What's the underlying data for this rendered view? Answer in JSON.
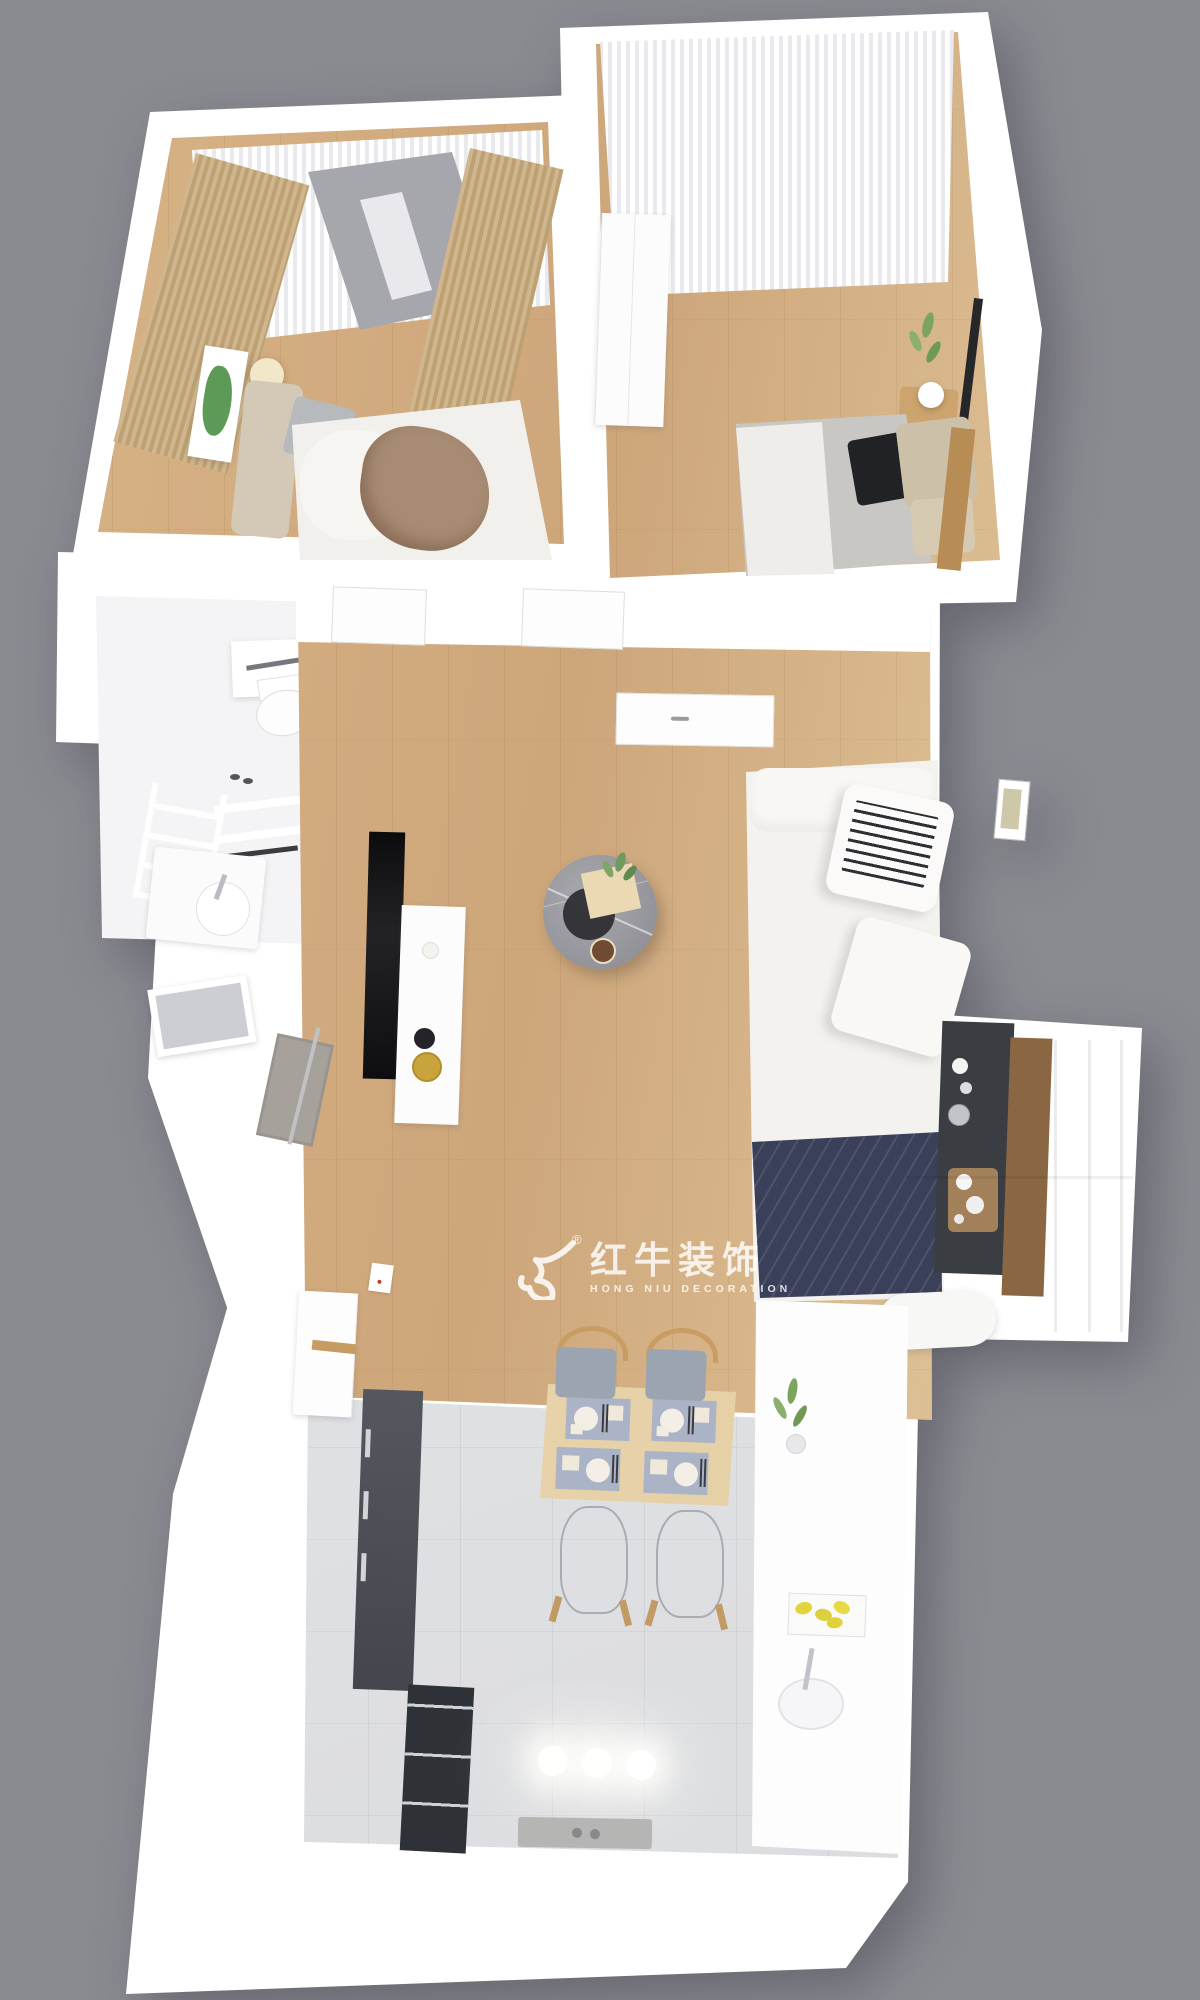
{
  "scene": {
    "kind": "3d-apartment-floorplan-render",
    "camera": "top-down-dollhouse-view",
    "background_color": "#8a8a91"
  },
  "watermark": {
    "logo": "hongniu-bull-logo",
    "registered": "®",
    "brand_cn": "红牛装饰",
    "brand_en": "HONG NIU DECORATION"
  },
  "palette": {
    "wall_white": "#ffffff",
    "wood_floor": "#d2ab7e",
    "tile_floor": "#e0e1e3",
    "curtain_tan": "#c8af88",
    "sheer_white": "#f2f2f5",
    "sofa_white": "#f5f4f1",
    "throw_navy": "#3a4059",
    "coffee_table_marble": "#97979d",
    "desk_dark": "#3a3d42",
    "desk_wood": "#8a6742",
    "chair_gray": "#9aa5b1",
    "chair_wood": "#c99d62",
    "appliance_dark": "#4b4f55",
    "lemon_yellow": "#e4d43c",
    "plant_green": "#7ca45f",
    "bed_throw_brown": "#a78b73",
    "pillow_black": "#202226",
    "pillow_beige": "#ccc0a9"
  },
  "rooms": [
    {
      "id": "bedroom-master",
      "features": [
        "tan-curtains",
        "sheer-window",
        "green-wall-art",
        "ball-lamp",
        "bed-gray-pillows-brown-throw",
        "wood-floor"
      ]
    },
    {
      "id": "bedroom-second",
      "features": [
        "sheer-curtain-wall",
        "white-wardrobe",
        "plant-wall-decal",
        "picture-frame",
        "bedside-bench-lamp",
        "bed-black-beige-pillows",
        "wood-floor"
      ]
    },
    {
      "id": "bathroom",
      "features": [
        "toilet",
        "mirror",
        "ladder-towel-rack",
        "shelves",
        "vanity-sink"
      ]
    },
    {
      "id": "living-room",
      "features": [
        "wall-tv",
        "white-tv-console",
        "round-marble-coffee-table",
        "white-sofa",
        "books",
        "navy-throw",
        "dark-desk-sideboard",
        "wall-art",
        "wood-floor"
      ]
    },
    {
      "id": "entry-hall",
      "features": [
        "interior-doors",
        "doormat",
        "window"
      ]
    },
    {
      "id": "kitchen-dining",
      "features": [
        "wood-dining-table",
        "four-place-settings",
        "gray-chairs",
        "ghost-chairs",
        "pendant-lights",
        "white-cabinets",
        "dark-appliance",
        "lemon-tray",
        "plant",
        "sink",
        "tile-floor"
      ]
    },
    {
      "id": "balcony-right",
      "features": [
        "window-frames"
      ]
    }
  ]
}
